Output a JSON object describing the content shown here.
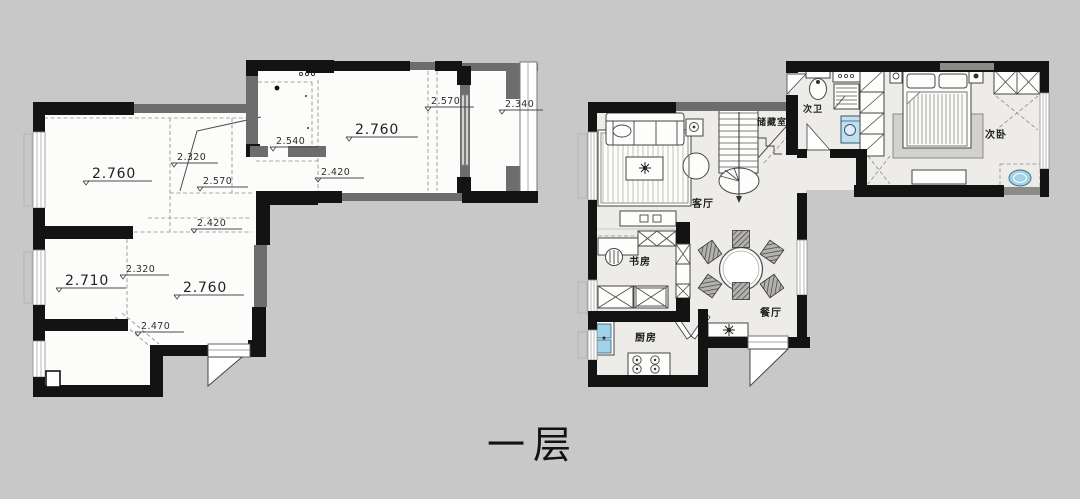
{
  "colors": {
    "background": "#c8c8c8",
    "wall_black": "#131313",
    "wall_gray": "#6d6d6d",
    "left_plan_floor": "#fcfcfb",
    "right_plan_floor": "#edece8",
    "fixture_blue": "#a3d2e8"
  },
  "title": {
    "text": "一层"
  },
  "left_plan": {
    "type": "ceiling-height-plan",
    "labels": [
      {
        "text": "2.760"
      },
      {
        "text": "2.320"
      },
      {
        "text": "2.570"
      },
      {
        "text": "2.420"
      },
      {
        "text": "2.540"
      },
      {
        "text": "2.760"
      },
      {
        "text": "2.570"
      },
      {
        "text": "2.340"
      },
      {
        "text": "2.420"
      },
      {
        "text": "2.710"
      },
      {
        "text": "2.320"
      },
      {
        "text": "2.760"
      },
      {
        "text": "2.470"
      }
    ]
  },
  "right_plan": {
    "type": "furnished-floor-plan",
    "rooms": [
      {
        "label": "客厅"
      },
      {
        "label": "储藏室"
      },
      {
        "label": "次卫"
      },
      {
        "label": "次卧"
      },
      {
        "label": "书房"
      },
      {
        "label": "餐厅"
      },
      {
        "label": "厨房"
      }
    ]
  }
}
